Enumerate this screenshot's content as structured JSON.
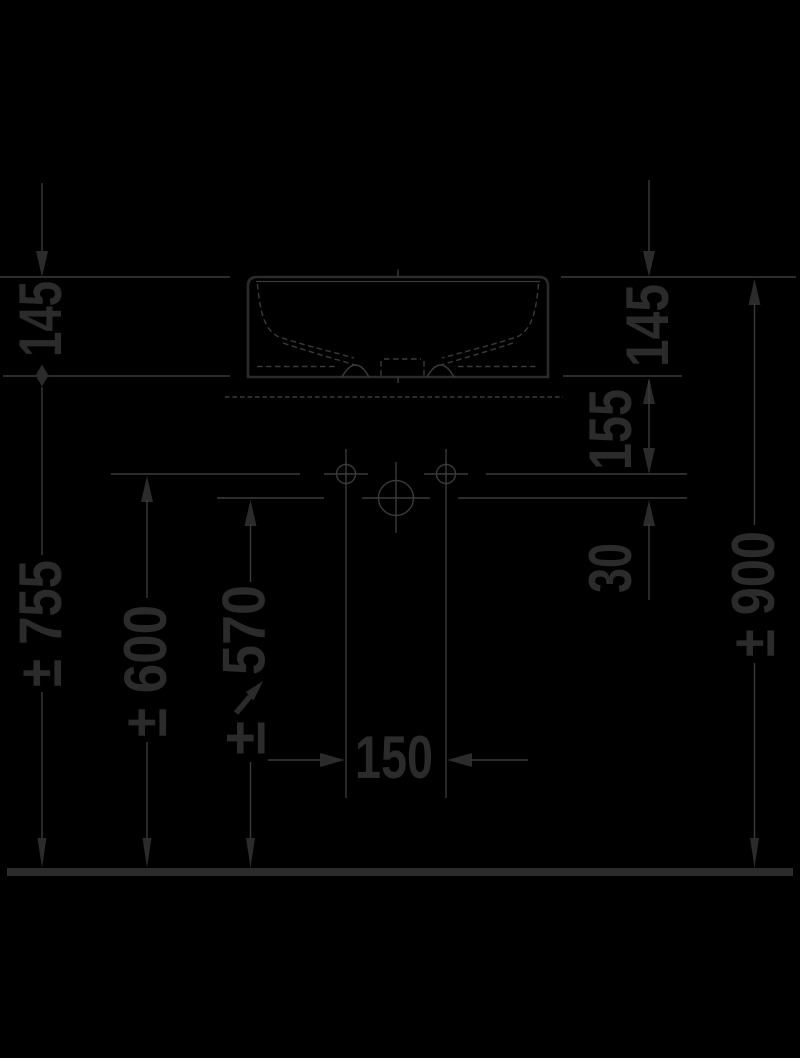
{
  "drawing": {
    "kind": "washbasin-front-elevation-technical-drawing",
    "background": "#000000",
    "ink": "#2b2b2b",
    "line_color": "#3a3a3a",
    "labels": {
      "height_145_left": "145",
      "height_145_right": "145",
      "offset_155_right": "155",
      "offset_30_right": "30",
      "height_900_right": "± 900",
      "height_755_left": "± 755",
      "height_600_left": "± 600",
      "height_570_value": "570",
      "height_570_prefix": "±",
      "hole_spacing_150": "150"
    }
  }
}
